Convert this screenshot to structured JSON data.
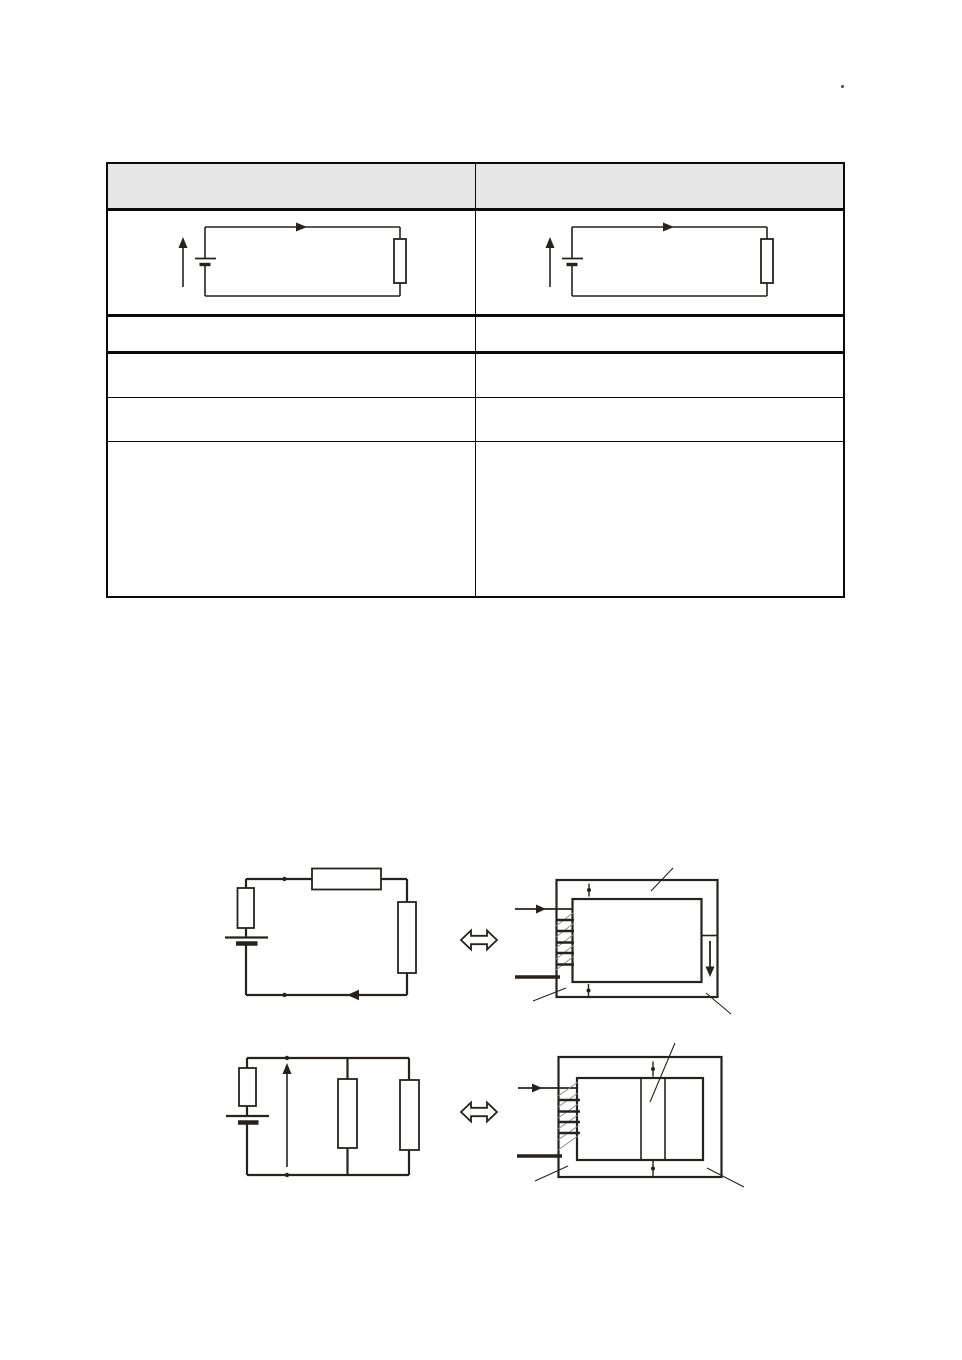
{
  "page": {
    "kind": "document-page",
    "stray_mark": "."
  },
  "theme": {
    "page_background": "#ffffff",
    "line_color": "#26221f",
    "table_border_color": "#0a0a0a",
    "header_fill": "#e6e6e6",
    "hatch_color": "#8a8a8a"
  },
  "comparison_table": {
    "header": {
      "left": "",
      "right": ""
    },
    "diagram_row": {
      "left_figure": "simple-battery-resistor-loop-circuit",
      "right_figure": "simple-battery-resistor-loop-circuit"
    },
    "empty_rows": [
      {
        "left": "",
        "right": ""
      },
      {
        "left": "",
        "right": ""
      },
      {
        "left": "",
        "right": ""
      },
      {
        "left": "",
        "right": ""
      }
    ]
  },
  "figures": {
    "series_equivalence": {
      "left_figure": "series-circuit-battery-three-resistors",
      "relation_symbol": "double-headed-arrow",
      "right_figure": "closed-flow-loop-with-pump-and-restriction"
    },
    "parallel_equivalence": {
      "left_figure": "parallel-circuit-battery-two-resistor-branches",
      "relation_symbol": "double-headed-arrow",
      "right_figure": "closed-flow-loop-with-pump-and-two-channels"
    }
  }
}
